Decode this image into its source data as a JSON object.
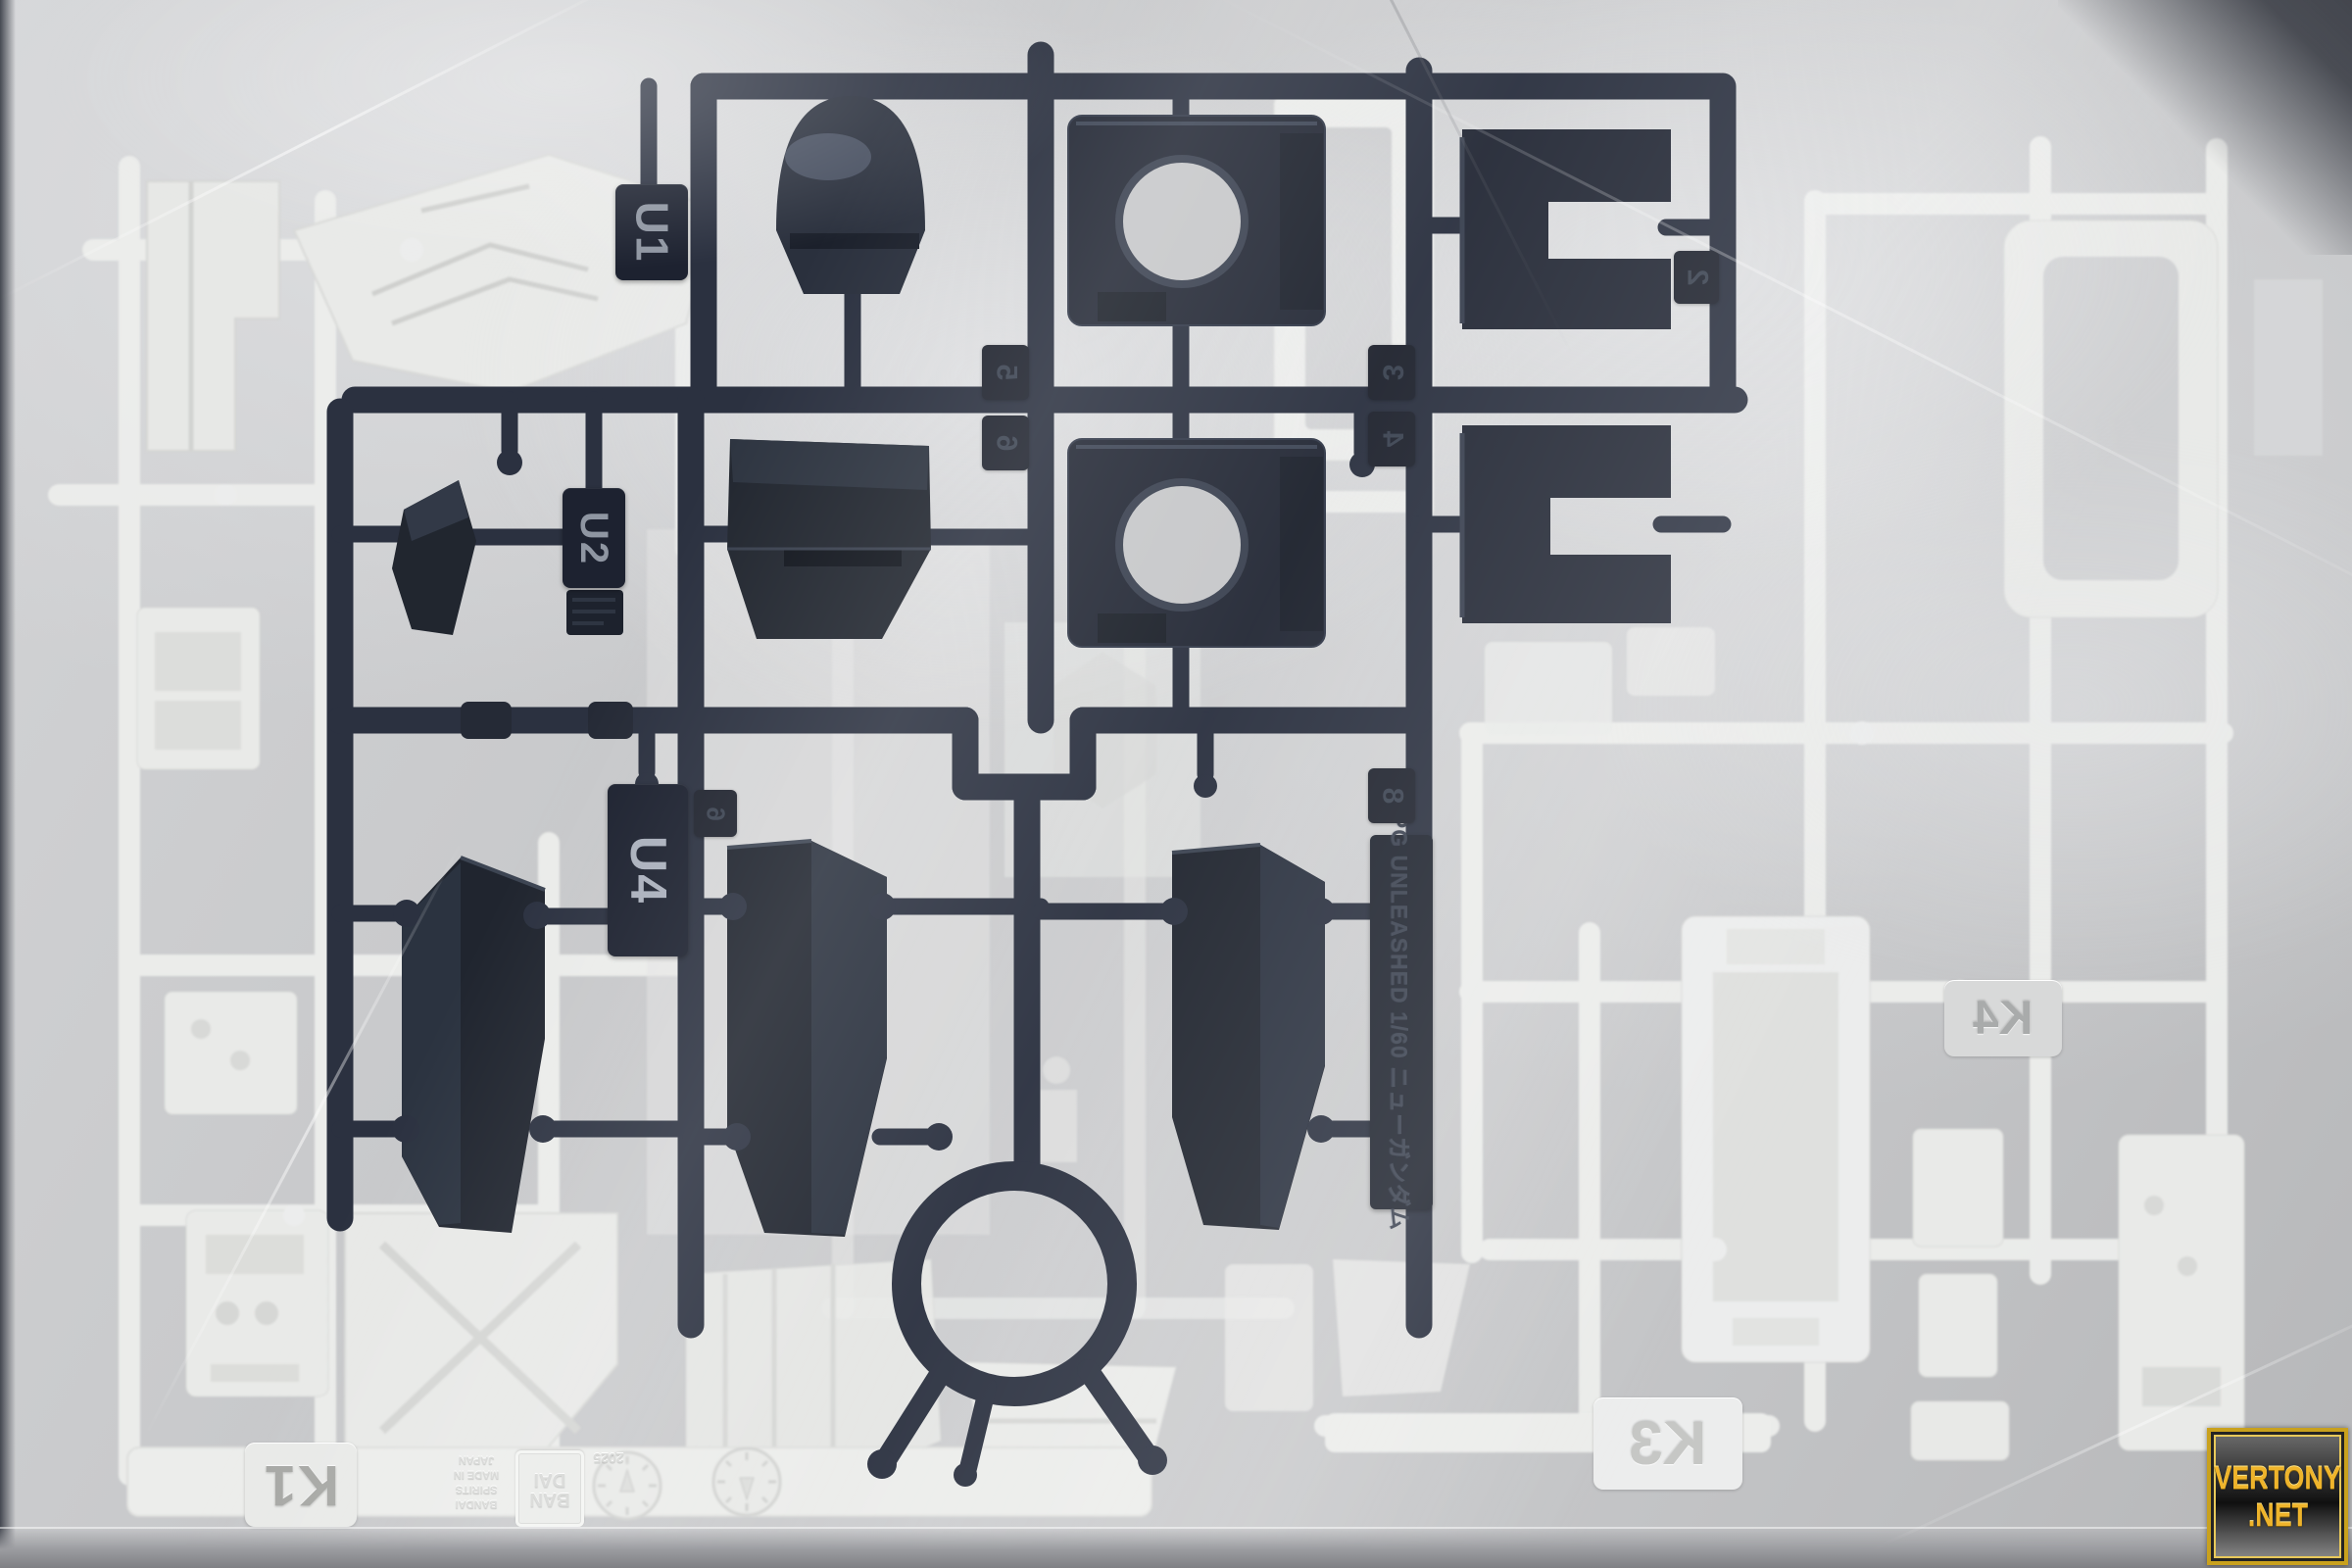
{
  "photo": {
    "subject": "Bandai model kit runners (sprues) sealed in a clear plastic bag",
    "kit_label": "PG UNLEASHED 1/60 ニューガンダム"
  },
  "dark_sprue": {
    "color": "#272c38",
    "tags": {
      "u1": "U1",
      "u2": "U2",
      "u4": "U4"
    },
    "side_text": "PG UNLEASHED 1/60 ニューガンダム",
    "gate_numbers": {
      "n2": "2",
      "n3": "3",
      "n4": "4",
      "n5": "5",
      "n6": "6",
      "n8": "8"
    }
  },
  "white_sprue": {
    "color": "#ebecea",
    "tags": {
      "k1": "K1",
      "k3": "K3",
      "k4": "K4"
    },
    "brand_top": "BAN",
    "brand_bottom": "DAI",
    "molded_line1": "BANDAI SPIRITS",
    "molded_line2": "MADE IN JAPAN",
    "molded_year": "2025"
  },
  "watermark": {
    "line1": "VERTONY",
    "line2": ".NET",
    "gold": "#e8b42f"
  }
}
